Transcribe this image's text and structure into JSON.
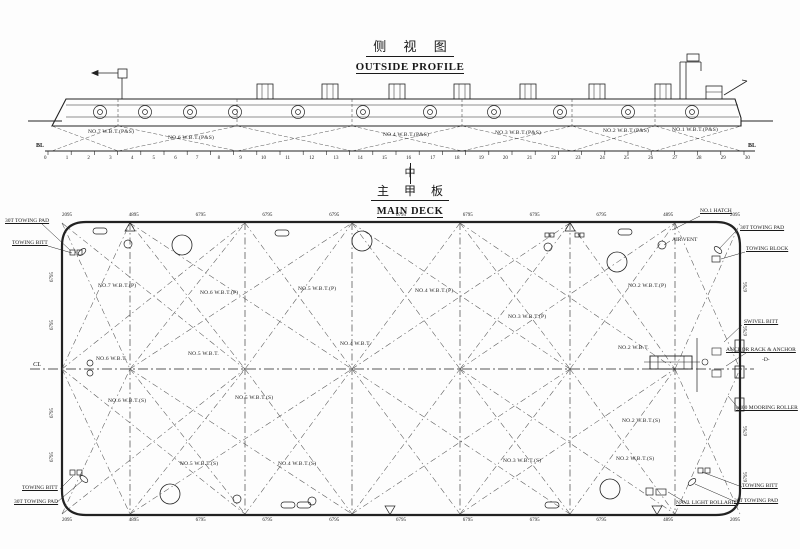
{
  "profile": {
    "title_zh": "侧 视 图",
    "title_en": "OUTSIDE PROFILE",
    "baseline_left": "BL",
    "baseline_right": "BL",
    "frame_numbers": [
      "0",
      "1",
      "2",
      "3",
      "4",
      "5",
      "6",
      "7",
      "8",
      "9",
      "10",
      "11",
      "12",
      "13",
      "14",
      "15",
      "16",
      "17",
      "18",
      "19",
      "20",
      "21",
      "22",
      "23",
      "24",
      "25",
      "26",
      "27",
      "28",
      "29",
      "30"
    ],
    "tank_labels": [
      {
        "text": "NO.7 W.B.T.(P&S)",
        "x": 88,
        "y": 130
      },
      {
        "text": "NO.6 W.B.T.(P&S)",
        "x": 168,
        "y": 136
      },
      {
        "text": "NO.4 W.B.T.(P&S)",
        "x": 383,
        "y": 133
      },
      {
        "text": "NO.3 W.B.T.(P&S)",
        "x": 495,
        "y": 131
      },
      {
        "text": "NO.2 W.B.T.(P&S)",
        "x": 603,
        "y": 129
      },
      {
        "text": "NO.1 W.B.T.(P&S)",
        "x": 672,
        "y": 128
      }
    ]
  },
  "deck": {
    "centerline_symbol": "中",
    "title_zh": "主 甲 板",
    "title_en": "MAIN DECK",
    "cl_label": "CL",
    "dims_top": [
      "2095",
      "4895",
      "6795",
      "6795",
      "6795",
      "6795",
      "6795",
      "6795",
      "6795",
      "4895",
      "2095"
    ],
    "dims_bottom": [
      "2095",
      "4895",
      "6795",
      "6795",
      "6795",
      "6795",
      "6795",
      "6795",
      "6795",
      "4895",
      "2095"
    ],
    "dims_left": [
      {
        "text": "6795",
        "x": 50,
        "y": 282
      },
      {
        "text": "6795",
        "x": 50,
        "y": 330
      },
      {
        "text": "6795",
        "x": 50,
        "y": 418
      },
      {
        "text": "6795",
        "x": 50,
        "y": 462
      }
    ],
    "dims_right": [
      {
        "text": "6795",
        "x": 744,
        "y": 292
      },
      {
        "text": "6795",
        "x": 744,
        "y": 336
      },
      {
        "text": "6795",
        "x": 744,
        "y": 436
      },
      {
        "text": "6795",
        "x": 744,
        "y": 482
      }
    ],
    "tanks": [
      {
        "text": "NO.7 W.B.T.(P)",
        "x": 98,
        "y": 284
      },
      {
        "text": "NO.6 W.B.T.(P)",
        "x": 200,
        "y": 291
      },
      {
        "text": "NO.5 W.B.T.(P)",
        "x": 298,
        "y": 287
      },
      {
        "text": "NO.4 W.B.T.(P)",
        "x": 415,
        "y": 289
      },
      {
        "text": "NO.3 W.B.T.(P)",
        "x": 508,
        "y": 315
      },
      {
        "text": "NO.2 W.B.T.(P)",
        "x": 628,
        "y": 284
      },
      {
        "text": "NO.6 W.B.T.",
        "x": 96,
        "y": 357
      },
      {
        "text": "NO.5 W.B.T.",
        "x": 188,
        "y": 352
      },
      {
        "text": "NO.4 W.B.T.",
        "x": 340,
        "y": 342
      },
      {
        "text": "NO.2 W.B.T.",
        "x": 618,
        "y": 346
      },
      {
        "text": "NO.6 W.B.T.(S)",
        "x": 108,
        "y": 399
      },
      {
        "text": "NO.5 W.B.T.(S)",
        "x": 235,
        "y": 396
      },
      {
        "text": "NO.2 W.B.T.(S)",
        "x": 622,
        "y": 419
      },
      {
        "text": "NO.5 W.B.T.(S)",
        "x": 180,
        "y": 462
      },
      {
        "text": "NO.4 W.B.T.(S)",
        "x": 278,
        "y": 462
      },
      {
        "text": "NO.3 W.B.T.(S)",
        "x": 503,
        "y": 459
      },
      {
        "text": "NO.2 W.B.T.(S)",
        "x": 616,
        "y": 457
      }
    ],
    "callouts": [
      {
        "text": "30T TOWING PAD",
        "x": 5,
        "y": 219
      },
      {
        "text": "TOWING BITT",
        "x": 12,
        "y": 241
      },
      {
        "text": "NO.1 HATCH",
        "x": 700,
        "y": 209
      },
      {
        "text": "30T TOWING PAD",
        "x": 740,
        "y": 226
      },
      {
        "text": "TOWING BLOCK",
        "x": 746,
        "y": 247
      },
      {
        "text": "SWIVEL BITT",
        "x": 744,
        "y": 320
      },
      {
        "text": "ANCHOR RACK & ANCHOR",
        "x": 726,
        "y": 348
      },
      {
        "text": "φ400 MOORING ROLLER",
        "x": 736,
        "y": 406
      },
      {
        "text": "TOWING BITT",
        "x": 742,
        "y": 484
      },
      {
        "text": "30T TOWING PAD",
        "x": 734,
        "y": 499
      },
      {
        "text": "NAVI. LIGHT BOLLARD",
        "x": 676,
        "y": 501
      },
      {
        "text": "TOWING BITT",
        "x": 22,
        "y": 486
      },
      {
        "text": "30T TOWING PAD",
        "x": 14,
        "y": 500
      }
    ],
    "notes": [
      {
        "text": "-D-",
        "x": 762,
        "y": 358
      },
      {
        "text": "AIR VENT",
        "x": 672,
        "y": 238
      }
    ]
  }
}
